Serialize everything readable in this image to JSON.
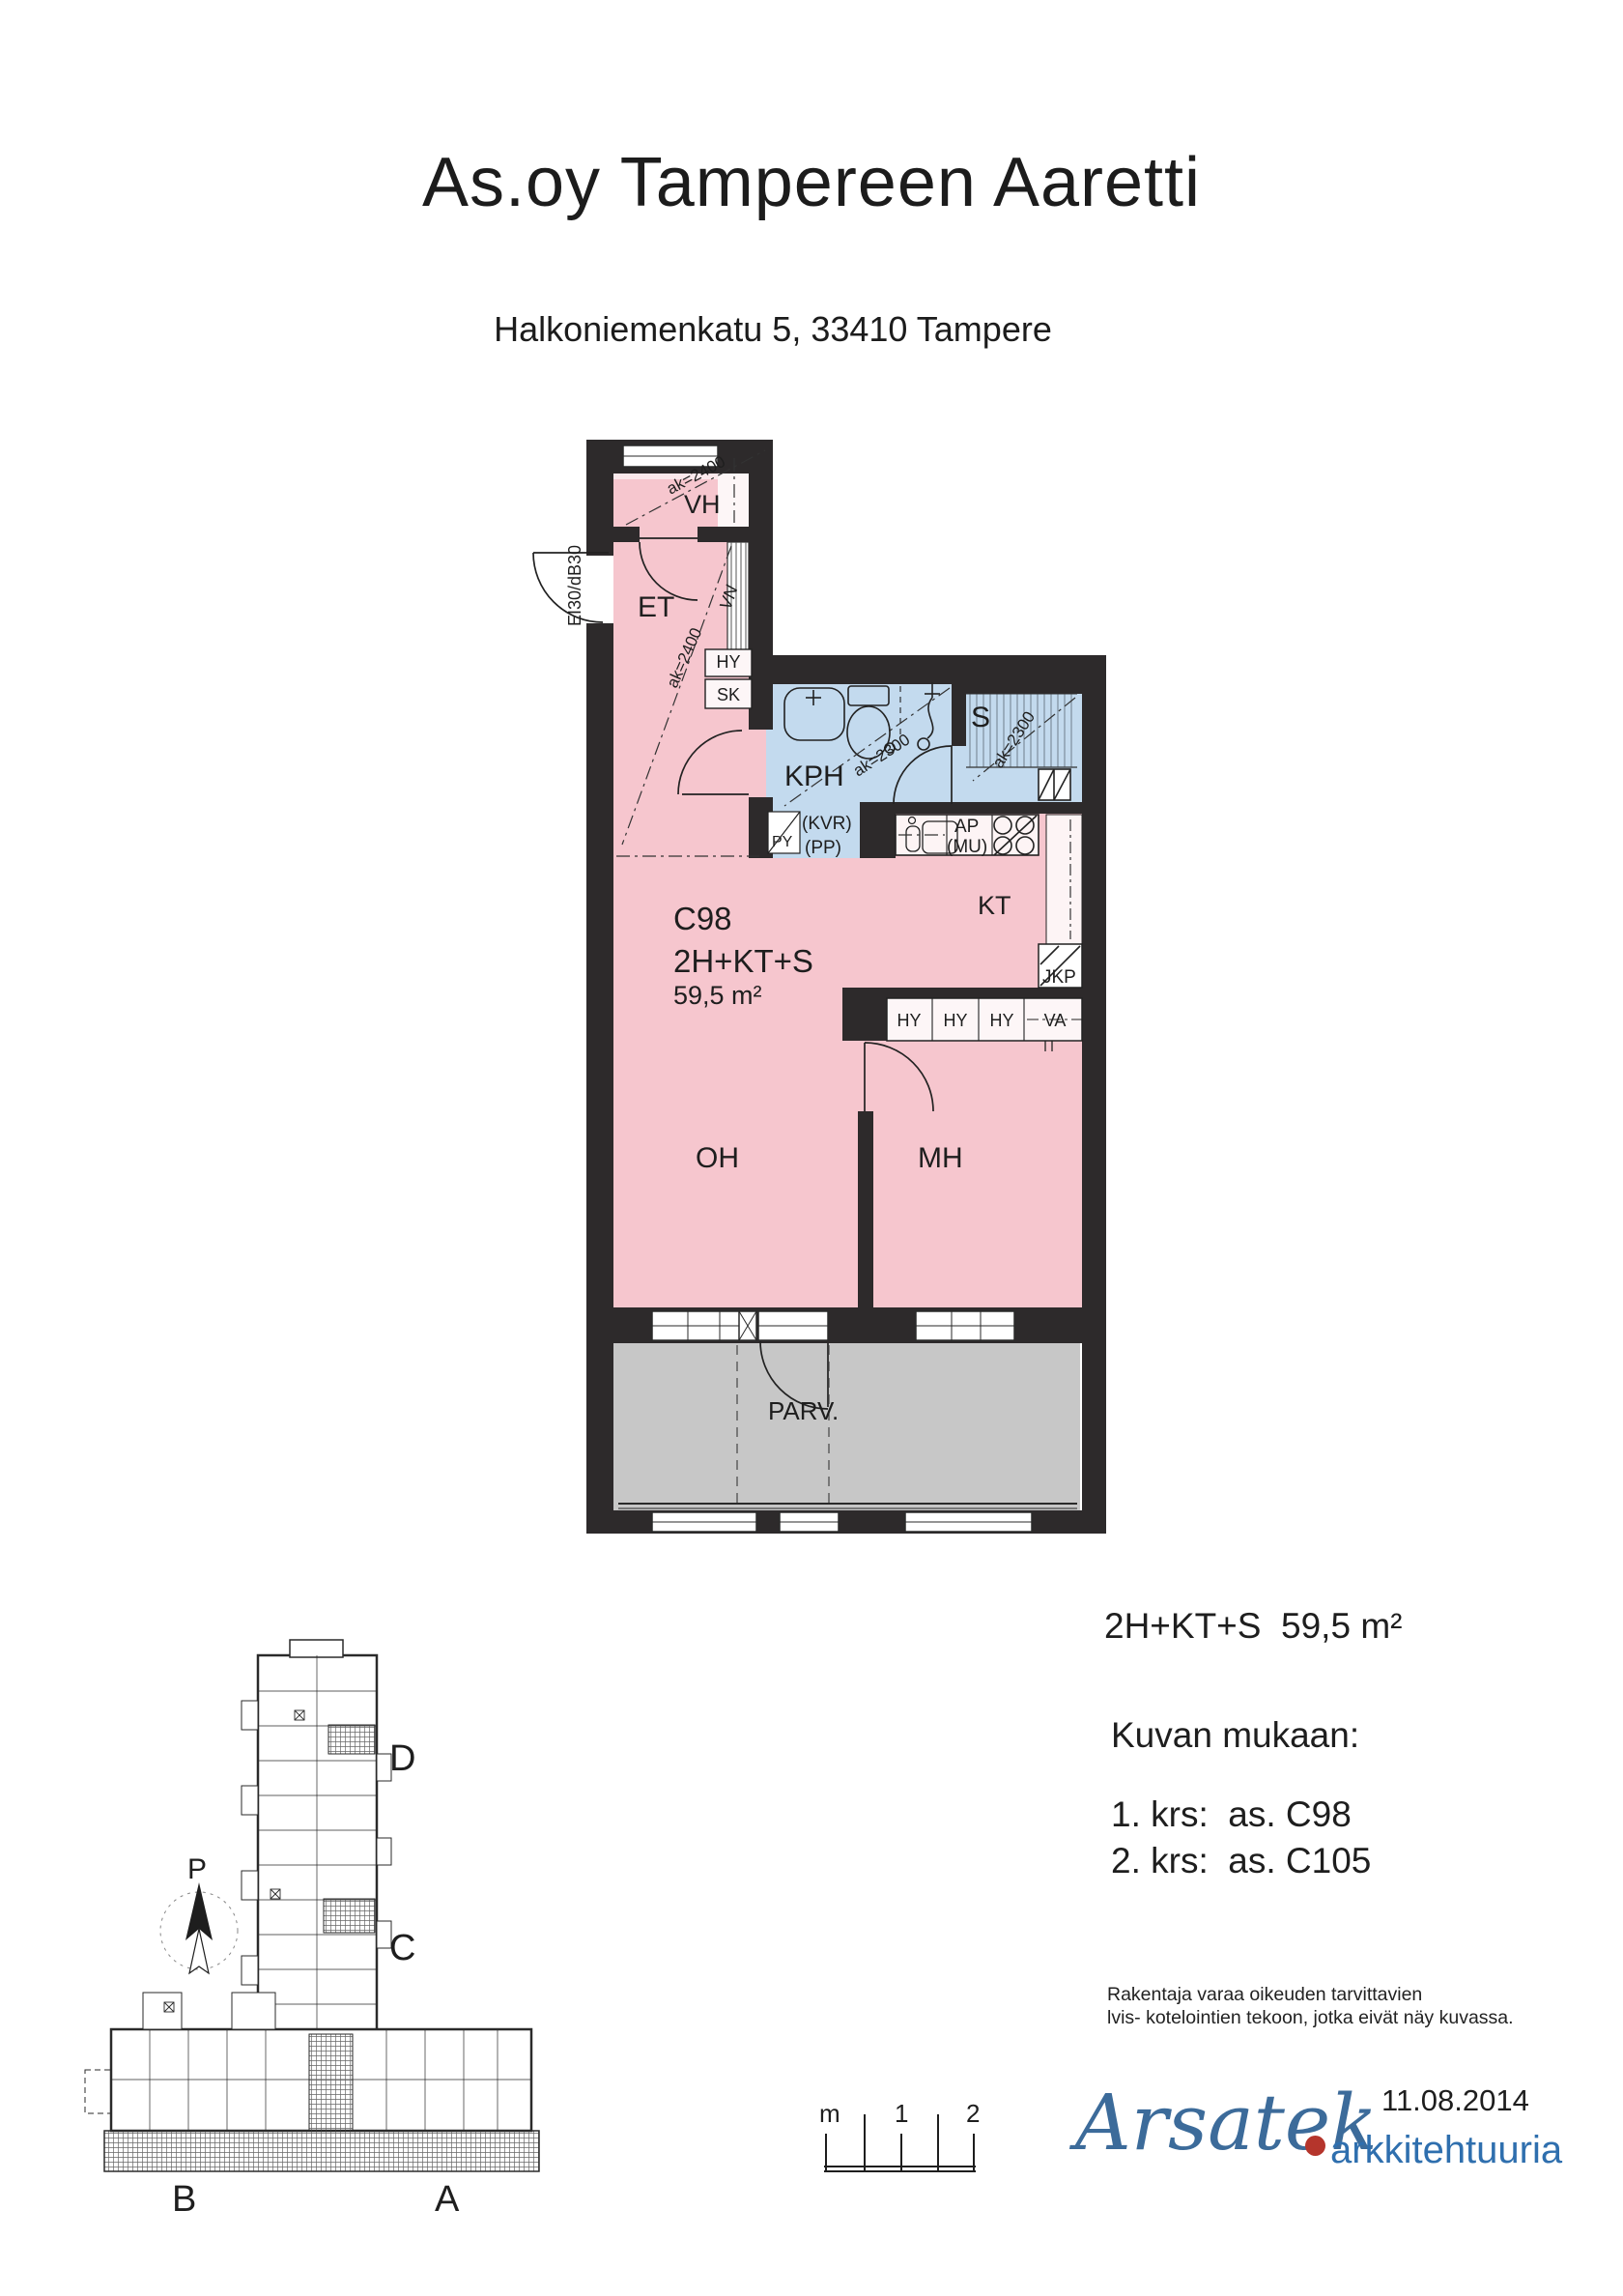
{
  "header": {
    "title": "As.oy Tampereen Aaretti",
    "subtitle": "Halkoniemenkatu 5,  33410 Tampere"
  },
  "colors": {
    "room_pink": "#f6c6ce",
    "room_pink_light": "#fbe9ec",
    "wet_blue": "#c3daee",
    "balcony_gray": "#c7c7c7",
    "wall_dark": "#2d2a2b",
    "logo_blue": "#3c6b9a",
    "logo_text_blue": "#2f6fae",
    "logo_red": "#b5352c"
  },
  "plan": {
    "unit_id": "C98",
    "unit_type": "2H+KT+S",
    "unit_area": "59,5 m²",
    "rooms": {
      "vh": "VH",
      "et": "ET",
      "kph": "KPH",
      "sauna": "S",
      "kt": "KT",
      "oh": "OH",
      "mh": "MH",
      "parv": "PARV."
    },
    "fixtures": {
      "hy": "HY",
      "sk": "SK",
      "vn": "VN",
      "py": "PY",
      "kvr": "(KVR)",
      "pp": "(PP)",
      "ap": "AP",
      "mu": "(MU)",
      "jkp": "JKP",
      "va": "VA"
    },
    "annotations": {
      "entry_door": "EI30/dB30",
      "ak_2400": "ak=2400",
      "ak_2300": "ak=2300"
    }
  },
  "site_plan": {
    "wing_a": "A",
    "wing_b": "B",
    "wing_c": "C",
    "wing_d": "D",
    "north": "P"
  },
  "scale_bar": {
    "unit": "m",
    "mid": "1",
    "end": "2"
  },
  "info": {
    "summary": "2H+KT+S  59,5 m²",
    "heading": "Kuvan mukaan:",
    "floor1": "1. krs:  as. C98",
    "floor2": "2. krs:  as. C105",
    "note1": "Rakentaja varaa oikeuden tarvittavien",
    "note2": "lvis- kotelointien tekoon, jotka eivät näy kuvassa.",
    "date": "11.08.2014"
  },
  "logo": {
    "name": "Arsatek",
    "tagline": "arkkitehtuuria"
  }
}
